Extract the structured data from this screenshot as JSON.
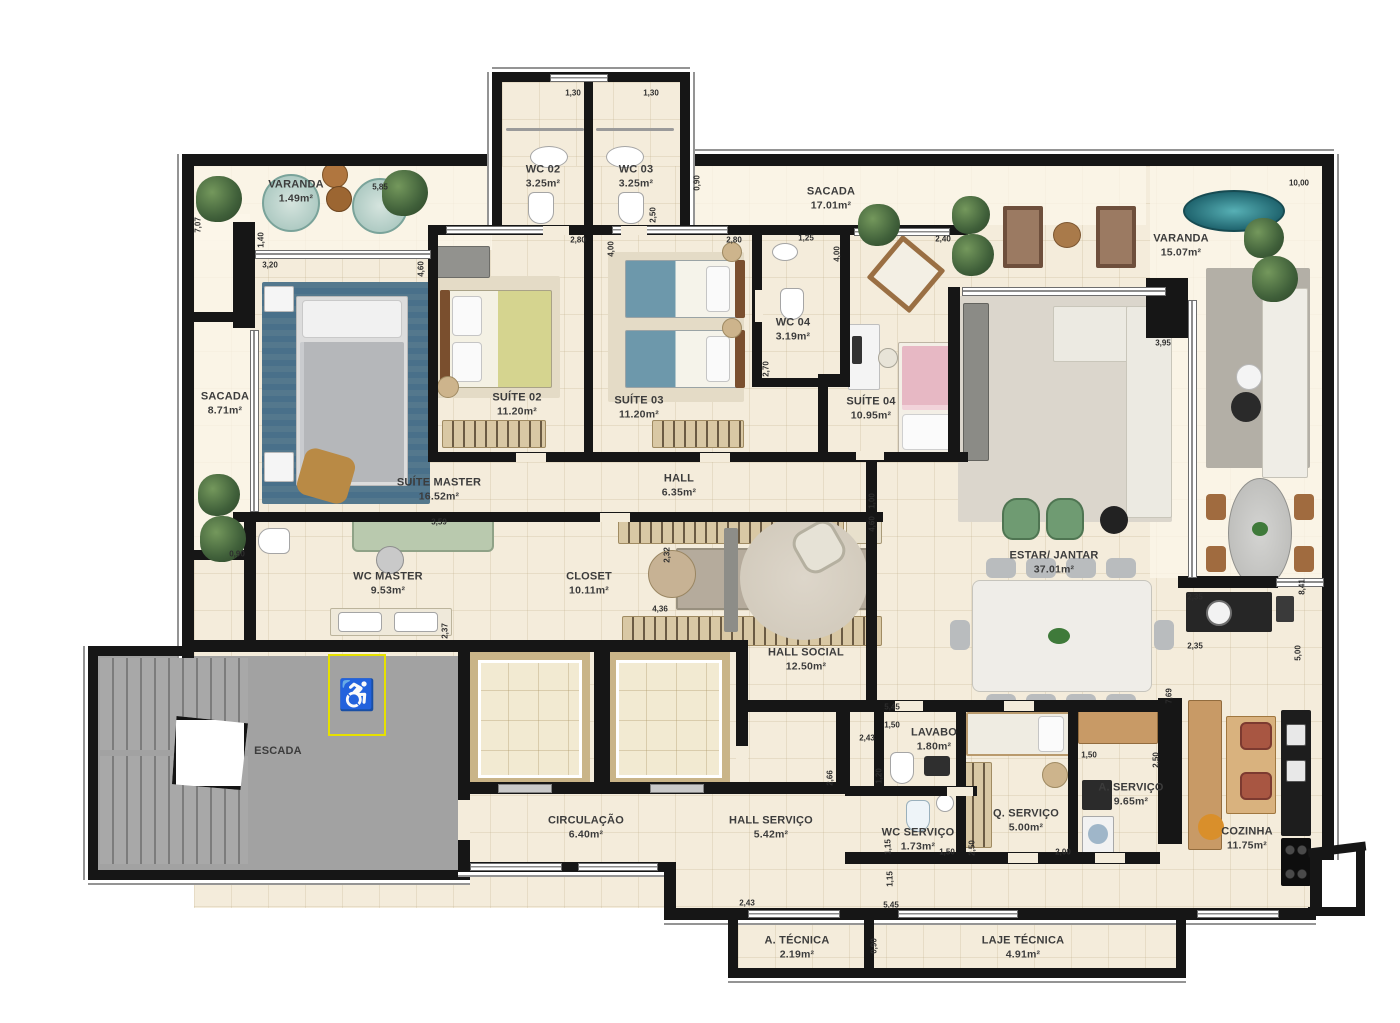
{
  "plan": {
    "type": "apartment-floor-plan",
    "accessibility_symbol": "♿"
  },
  "colors": {
    "wall": "#161616",
    "floor": "#f4ecdb",
    "balcony_floor": "#faf4e6",
    "stair_gray": "#a2a2a2",
    "accessible_yellow": "#e6e000",
    "master_rug_blue": "#54788d",
    "suite03_blanket_teal": "#6d98ab",
    "suite04_blanket_pink": "#e7b8c4",
    "armchair_green": "#6f9b72"
  },
  "rooms": {
    "varanda_tl": {
      "label": "VARANDA",
      "area": "1.49m²"
    },
    "sacada_left": {
      "label": "SACADA",
      "area": "8.71m²"
    },
    "wc02": {
      "label": "WC 02",
      "area": "3.25m²"
    },
    "wc03": {
      "label": "WC 03",
      "area": "3.25m²"
    },
    "sacada_top": {
      "label": "SACADA",
      "area": "17.01m²"
    },
    "varanda_right": {
      "label": "VARANDA",
      "area": "15.07m²"
    },
    "suite02": {
      "label": "SUÍTE 02",
      "area": "11.20m²"
    },
    "suite03": {
      "label": "SUÍTE 03",
      "area": "11.20m²"
    },
    "wc04": {
      "label": "WC 04",
      "area": "3.19m²"
    },
    "suite04": {
      "label": "SUÍTE 04",
      "area": "10.95m²"
    },
    "suite_master": {
      "label": "SUÍTE MASTER",
      "area": "16.52m²"
    },
    "hall": {
      "label": "HALL",
      "area": "6.35m²"
    },
    "wc_master": {
      "label": "WC MASTER",
      "area": "9.53m²"
    },
    "closet": {
      "label": "CLOSET",
      "area": "10.11m²"
    },
    "hall_social": {
      "label": "HALL SOCIAL",
      "area": "12.50m²"
    },
    "estar_jantar": {
      "label": "ESTAR/ JANTAR",
      "area": "37.01m²"
    },
    "lavabo": {
      "label": "LAVABO",
      "area": "1.80m²"
    },
    "wc_servico": {
      "label": "WC SERVIÇO",
      "area": "1.73m²"
    },
    "q_servico": {
      "label": "Q. SERVIÇO",
      "area": "5.00m²"
    },
    "a_servico": {
      "label": "A. SERVIÇO",
      "area": "9.65m²"
    },
    "cozinha": {
      "label": "COZINHA",
      "area": "11.75m²"
    },
    "escada": {
      "label": "ESCADA",
      "area": ""
    },
    "circulacao": {
      "label": "CIRCULAÇÃO",
      "area": "6.40m²"
    },
    "hall_servico": {
      "label": "HALL SERVIÇO",
      "area": "5.42m²"
    },
    "a_tecnica": {
      "label": "A. TÉCNICA",
      "area": "2.19m²"
    },
    "laje_tecnica": {
      "label": "LAJE TÉCNICA",
      "area": "4.91m²"
    }
  },
  "dims": [
    "7,07",
    "5,85",
    "1,30",
    "1,30",
    "0,90",
    "2,50",
    "2,80",
    "4,00",
    "4,60",
    "2,80",
    "1,25",
    "4,00",
    "2,40",
    "10,00",
    "3,95",
    "8,41",
    "2,35",
    "2,35",
    "7,69",
    "5,00",
    "3,20",
    "1,40",
    "0,90",
    "3,59",
    "2,37",
    "2,32",
    "4,36",
    "1,00",
    "4,60",
    "2,70",
    "5,45",
    "1,50",
    "2,43",
    "1,20",
    "2,66",
    "1,15",
    "1,15",
    "1,50",
    "2,50",
    "2,00",
    "1,50",
    "2,50",
    "2,43",
    "5,45",
    "0,90"
  ]
}
